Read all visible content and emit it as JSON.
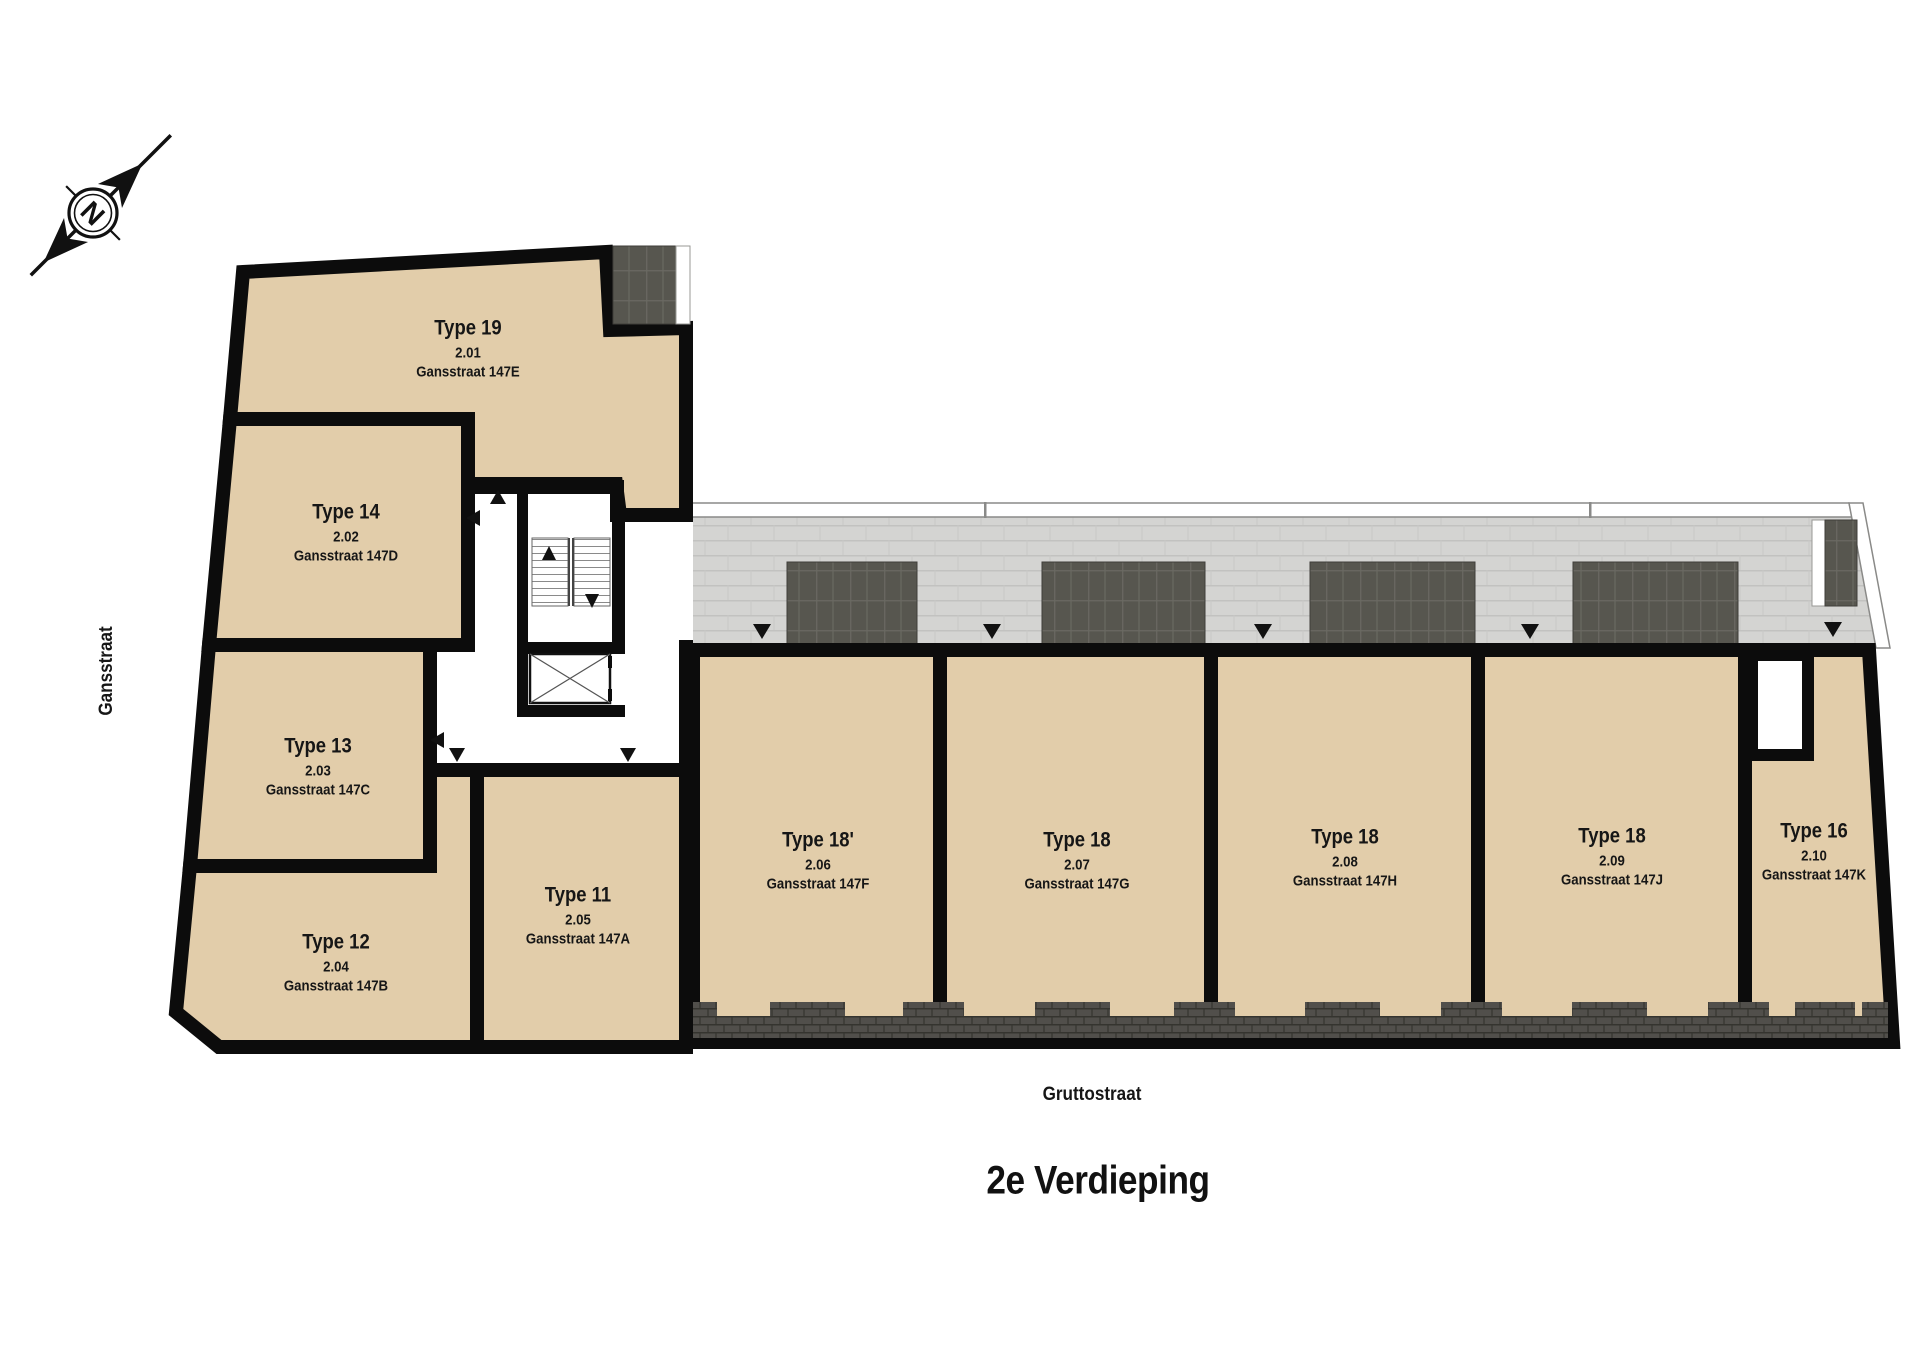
{
  "floor_title": "2e Verdieping",
  "streets": {
    "left": "Gansstraat",
    "bottom": "Gruttostraat"
  },
  "compass": {
    "label": "N"
  },
  "units": [
    {
      "type": "Type 19",
      "number": "2.01",
      "address": "Gansstraat 147E"
    },
    {
      "type": "Type 14",
      "number": "2.02",
      "address": "Gansstraat 147D"
    },
    {
      "type": "Type 13",
      "number": "2.03",
      "address": "Gansstraat 147C"
    },
    {
      "type": "Type 12",
      "number": "2.04",
      "address": "Gansstraat 147B"
    },
    {
      "type": "Type 11",
      "number": "2.05",
      "address": "Gansstraat 147A"
    },
    {
      "type": "Type 18'",
      "number": "2.06",
      "address": "Gansstraat 147F"
    },
    {
      "type": "Type 18",
      "number": "2.07",
      "address": "Gansstraat 147G"
    },
    {
      "type": "Type 18",
      "number": "2.08",
      "address": "Gansstraat 147H"
    },
    {
      "type": "Type 18",
      "number": "2.09",
      "address": "Gansstraat 147J"
    },
    {
      "type": "Type 16",
      "number": "2.10",
      "address": "Gansstraat 147K"
    }
  ],
  "colors": {
    "unit_fill": "#e2cdaa",
    "wall": "#0c0c0c",
    "walkway_tile": "#d4d4d2",
    "terrace_block": "#57564f",
    "facade_brick": "#514f4b"
  }
}
